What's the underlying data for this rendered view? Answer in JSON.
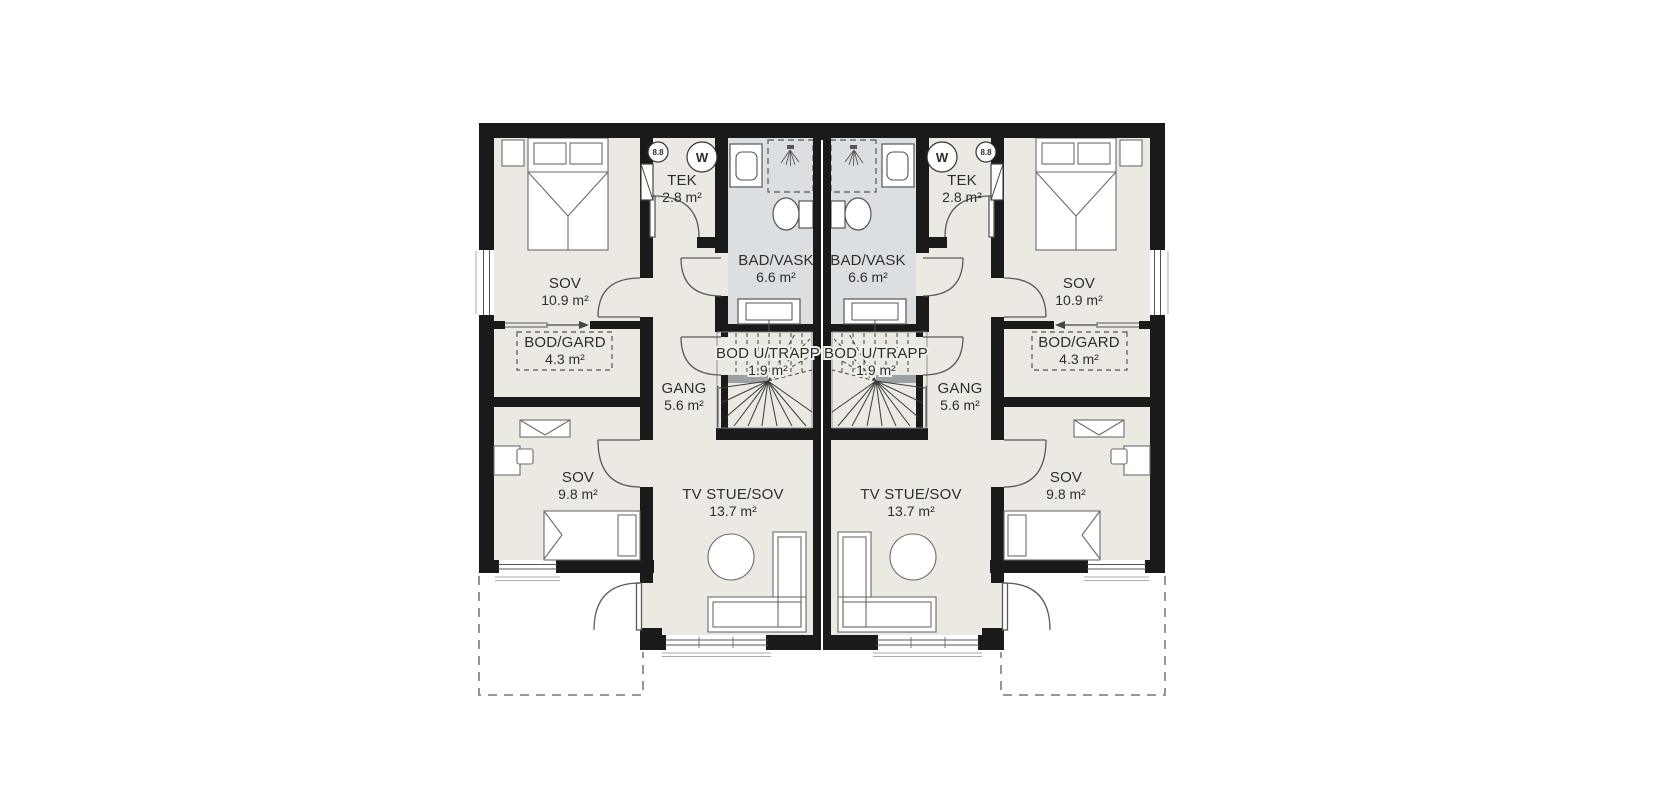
{
  "document": {
    "kind": "architectural-floor-plan",
    "style": "duplex-mirrored"
  },
  "colors": {
    "wall": "#1a1a1a",
    "floor": "#ebe9e2",
    "bath_floor": "#dcdfe2",
    "furniture_line": "#5a5a5a",
    "dash_line": "#8a8a8a",
    "text": "#2e2e2e",
    "stair_landing": "#9ba1a5",
    "background": "#ffffff"
  },
  "symbols": {
    "washing_machine": "W",
    "ventilation": "8.8"
  },
  "units": {
    "left": {
      "rooms": {
        "sov_main": {
          "name": "SOV",
          "area": "10.9 m²"
        },
        "bod_gard": {
          "name": "BOD/GARD",
          "area": "4.3 m²"
        },
        "sov_small": {
          "name": "SOV",
          "area": "9.8 m²"
        },
        "tek": {
          "name": "TEK",
          "area": "2.8 m²"
        },
        "bad_vask": {
          "name": "BAD/VASK",
          "area": "6.6 m²"
        },
        "bod_u_trapp": {
          "name": "BOD U/TRAPP",
          "area": "1.9 m²"
        },
        "gang": {
          "name": "GANG",
          "area": "5.6 m²"
        },
        "tv_stue_sov": {
          "name": "TV STUE/SOV",
          "area": "13.7 m²"
        }
      }
    },
    "right": {
      "rooms": {
        "sov_main": {
          "name": "SOV",
          "area": "10.9 m²"
        },
        "bod_gard": {
          "name": "BOD/GARD",
          "area": "4.3 m²"
        },
        "sov_small": {
          "name": "SOV",
          "area": "9.8 m²"
        },
        "tek": {
          "name": "TEK",
          "area": "2.8 m²"
        },
        "bad_vask": {
          "name": "BAD/VASK",
          "area": "6.6 m²"
        },
        "bod_u_trapp": {
          "name": "BOD U/TRAPP",
          "area": "1.9 m²"
        },
        "gang": {
          "name": "GANG",
          "area": "5.6 m²"
        },
        "tv_stue_sov": {
          "name": "TV STUE/SOV",
          "area": "13.7 m²"
        }
      }
    }
  }
}
